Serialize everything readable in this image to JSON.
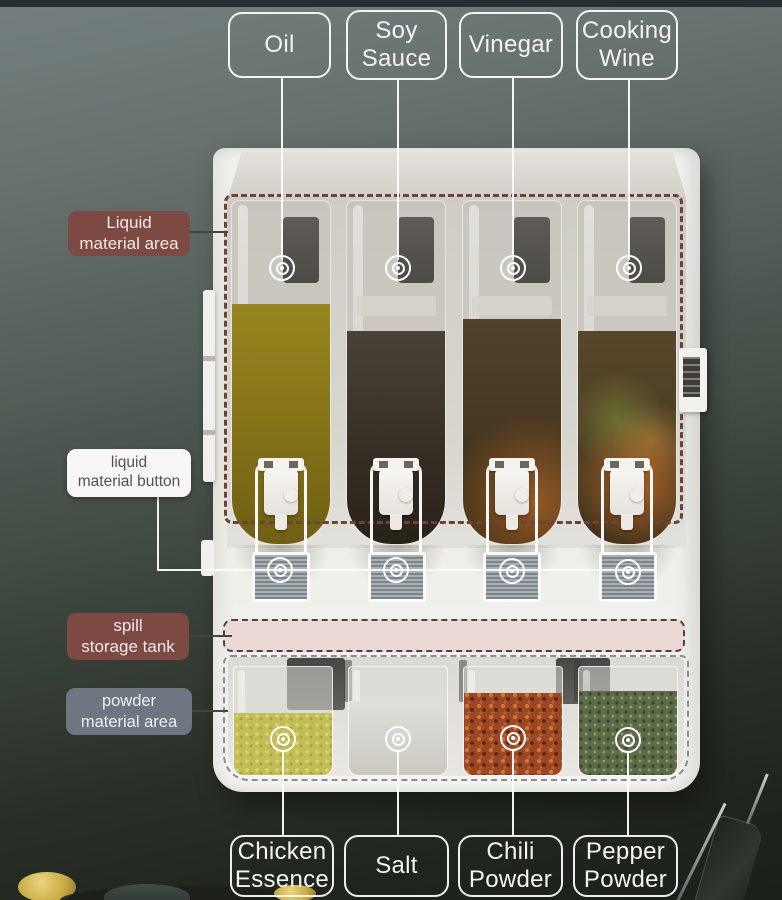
{
  "annotations": {
    "top_labels": [
      {
        "id": "oil",
        "line1": "Oil"
      },
      {
        "id": "soy-sauce",
        "line1": "Soy",
        "line2": "Sauce"
      },
      {
        "id": "vinegar",
        "line1": "Vinegar"
      },
      {
        "id": "cooking-wine",
        "line1": "Cooking",
        "line2": "Wine"
      }
    ],
    "side_labels": [
      {
        "id": "liquid-material-area",
        "line1": "Liquid",
        "line2": "material area"
      },
      {
        "id": "liquid-material-button",
        "line1": "liquid",
        "line2": "material button"
      },
      {
        "id": "spill-storage-tank",
        "line1": "spill",
        "line2": "storage tank"
      },
      {
        "id": "powder-material-area",
        "line1": "powder",
        "line2": "material area"
      }
    ],
    "bottom_labels": [
      {
        "id": "chicken-essence",
        "line1": "Chicken",
        "line2": "Essence"
      },
      {
        "id": "salt",
        "line1": "Salt"
      },
      {
        "id": "chili-powder",
        "line1": "Chili",
        "line2": "Powder"
      },
      {
        "id": "pepper-powder",
        "line1": "Pepper",
        "line2": "Powder"
      }
    ]
  },
  "icons": {
    "target_marker": "concentric-circles"
  },
  "colors": {
    "label_maroon": "#7c4a42",
    "label_gray_blue": "#6e7681",
    "label_white": "#f7f6f4",
    "outline_white": "#ffffff",
    "dashed_liquid_area": "#6e4337",
    "spill_tank_pink": "#ecd8d7",
    "dashed_powder_area": "#878e93",
    "oil_liquid": "#8a781c",
    "soy_sauce_liquid": "#3b342a",
    "vinegar_liquid": "#46371f",
    "cooking_wine_liquid": "#54432a",
    "chicken_essence_powder": "#c3bd58",
    "salt_powder": "#dcdad6",
    "chili_powder": "#9a4724",
    "pepper_powder": "#5c6b48"
  }
}
